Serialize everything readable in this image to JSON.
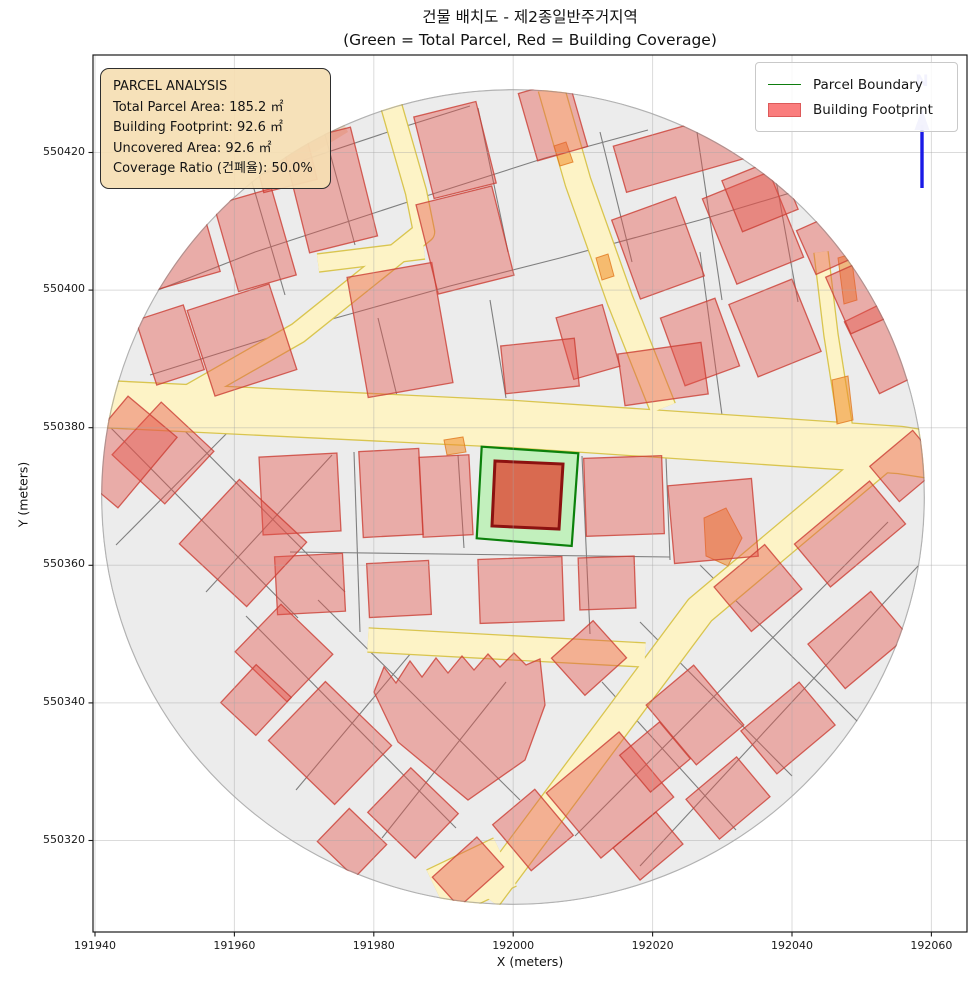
{
  "title": {
    "line1": "건물 배치도 - 제2종일반주거지역",
    "line2": "(Green = Total Parcel, Red = Building Coverage)"
  },
  "axes": {
    "xlabel": "X (meters)",
    "ylabel": "Y (meters)",
    "xticks": [
      191940,
      191960,
      191980,
      192000,
      192020,
      192040,
      192060
    ],
    "yticks": [
      550320,
      550340,
      550360,
      550380,
      550400,
      550420
    ]
  },
  "legend": {
    "items": [
      {
        "label": "Parcel Boundary",
        "swatch": "line",
        "color": "#0e7d0e"
      },
      {
        "label": "Building Footprint",
        "swatch": "patch",
        "color": "#fa7d7d",
        "edge": "#dd5a5a"
      }
    ]
  },
  "info_box": {
    "title": "PARCEL ANALYSIS",
    "lines": [
      "Total Parcel Area: 185.2 ㎡",
      "Building Footprint: 92.6 ㎡",
      "Uncovered Area: 92.6 ㎡",
      "Coverage Ratio (건폐율): 50.0%"
    ]
  },
  "north": {
    "label": "N",
    "line_color": "#1a1ae6",
    "glyph_color": "#b9b9f0"
  },
  "map": {
    "circle": {
      "cx": 513,
      "cy": 497,
      "rx": 412,
      "ry": 408
    },
    "colors": {
      "background": "#ececec",
      "parcel_line": "#7f7f7f",
      "road_fill": "#fdf3c6",
      "road_edge": "#d9c54f",
      "building_fill": "rgba(228,84,74,0.42)",
      "building_edge": "rgba(203,63,53,0.8)",
      "orange_fill": "rgba(240,140,40,0.55)",
      "orange_edge": "rgba(225,120,30,0.8)",
      "tan_fill": "rgba(225,170,110,0.35)",
      "parcel_area_fill": "rgba(190,240,185,0.92)",
      "parcel_area_edge": "#0b800b",
      "footprint_fill": "#d96a50",
      "footprint_edge": "#8c1210",
      "grid": "rgba(165,165,165,0.4)"
    },
    "roads": [
      {
        "pts": [
          [
            102,
            404
          ],
          [
            513,
            424
          ],
          [
            900,
            450
          ],
          [
            932,
            455
          ]
        ],
        "w": 46
      },
      {
        "pts": [
          [
            391,
            105
          ],
          [
            416,
            192
          ],
          [
            424,
            232
          ],
          [
            298,
            333
          ],
          [
            184,
            398
          ]
        ],
        "w": 20
      },
      {
        "pts": [
          [
            318,
            263
          ],
          [
            424,
            250
          ]
        ],
        "w": 17
      },
      {
        "pts": [
          [
            551,
            88
          ],
          [
            578,
            182
          ],
          [
            620,
            300
          ],
          [
            663,
            408
          ]
        ],
        "w": 25
      },
      {
        "pts": [
          [
            821,
            252
          ],
          [
            831,
            335
          ],
          [
            846,
            430
          ]
        ],
        "w": 13
      },
      {
        "pts": [
          [
            888,
            452
          ],
          [
            700,
            610
          ],
          [
            486,
            897
          ]
        ],
        "w": 30
      },
      {
        "pts": [
          [
            368,
            640
          ],
          [
            645,
            655
          ]
        ],
        "w": 23
      },
      {
        "pts": [
          [
            505,
            862
          ],
          [
            438,
            894
          ]
        ],
        "w": 52
      }
    ],
    "parcel_lines": [
      [
        [
          112,
          308
        ],
        [
          255,
          252
        ],
        [
          420,
          198
        ],
        [
          545,
          158
        ],
        [
          648,
          130
        ]
      ],
      [
        [
          135,
          218
        ],
        [
          268,
          172
        ],
        [
          400,
          128
        ],
        [
          470,
          106
        ]
      ],
      [
        [
          150,
          375
        ],
        [
          300,
          328
        ],
        [
          450,
          286
        ],
        [
          560,
          258
        ],
        [
          700,
          220
        ],
        [
          800,
          190
        ],
        [
          880,
          162
        ]
      ],
      [
        [
          228,
          100
        ],
        [
          285,
          295
        ]
      ],
      [
        [
          315,
          98
        ],
        [
          355,
          245
        ]
      ],
      [
        [
          478,
          108
        ],
        [
          508,
          252
        ]
      ],
      [
        [
          600,
          132
        ],
        [
          632,
          262
        ]
      ],
      [
        [
          697,
          132
        ],
        [
          722,
          300
        ]
      ],
      [
        [
          772,
          158
        ],
        [
          798,
          302
        ]
      ],
      [
        [
          378,
          318
        ],
        [
          398,
          400
        ]
      ],
      [
        [
          490,
          300
        ],
        [
          506,
          398
        ]
      ],
      [
        [
          700,
          252
        ],
        [
          722,
          415
        ]
      ],
      [
        [
          354,
          452
        ],
        [
          360,
          632
        ]
      ],
      [
        [
          458,
          455
        ],
        [
          464,
          548
        ]
      ],
      [
        [
          582,
          456
        ],
        [
          590,
          634
        ]
      ],
      [
        [
          666,
          458
        ],
        [
          670,
          560
        ]
      ],
      [
        [
          290,
          552
        ],
        [
          670,
          557
        ]
      ],
      [
        [
          108,
          425
        ],
        [
          298,
          618
        ]
      ],
      [
        [
          152,
          398
        ],
        [
          345,
          592
        ]
      ],
      [
        [
          240,
          420
        ],
        [
          116,
          545
        ]
      ],
      [
        [
          332,
          455
        ],
        [
          206,
          592
        ]
      ],
      [
        [
          246,
          616
        ],
        [
          456,
          828
        ]
      ],
      [
        [
          318,
          600
        ],
        [
          520,
          800
        ]
      ],
      [
        [
          422,
          640
        ],
        [
          296,
          790
        ]
      ],
      [
        [
          506,
          682
        ],
        [
          382,
          838
        ]
      ],
      [
        [
          888,
          522
        ],
        [
          575,
          836
        ]
      ],
      [
        [
          918,
          566
        ],
        [
          640,
          866
        ]
      ],
      [
        [
          700,
          565
        ],
        [
          858,
          722
        ]
      ],
      [
        [
          640,
          622
        ],
        [
          792,
          776
        ]
      ],
      [
        [
          602,
          682
        ],
        [
          736,
          830
        ]
      ]
    ],
    "buildings": [
      [
        175,
        248,
        74,
        70,
        -16
      ],
      [
        255,
        240,
        60,
        90,
        -16
      ],
      [
        282,
        152,
        55,
        70,
        -14
      ],
      [
        330,
        190,
        70,
        112,
        -14
      ],
      [
        170,
        345,
        50,
        68,
        -18
      ],
      [
        242,
        340,
        86,
        90,
        -18
      ],
      [
        400,
        330,
        86,
        122,
        -10
      ],
      [
        455,
        150,
        64,
        84,
        -14
      ],
      [
        465,
        240,
        78,
        92,
        -14
      ],
      [
        553,
        120,
        52,
        70,
        -16
      ],
      [
        680,
        152,
        125,
        48,
        -16
      ],
      [
        658,
        248,
        68,
        84,
        -20
      ],
      [
        753,
        228,
        72,
        92,
        -22
      ],
      [
        775,
        328,
        68,
        78,
        -22
      ],
      [
        700,
        342,
        58,
        72,
        -20
      ],
      [
        588,
        342,
        48,
        64,
        -16
      ],
      [
        888,
        345,
        58,
        80,
        -26
      ],
      [
        862,
        295,
        52,
        62,
        -24
      ],
      [
        760,
        195,
        60,
        55,
        -22
      ],
      [
        830,
        242,
        52,
        48,
        -24
      ],
      [
        540,
        366,
        74,
        48,
        -6
      ],
      [
        663,
        374,
        84,
        52,
        -8
      ],
      [
        300,
        494,
        78,
        78,
        -3
      ],
      [
        391,
        493,
        60,
        86,
        -3
      ],
      [
        446,
        496,
        50,
        80,
        -3
      ],
      [
        624,
        496,
        78,
        78,
        -2
      ],
      [
        713,
        521,
        84,
        78,
        -5
      ],
      [
        310,
        584,
        68,
        58,
        -3
      ],
      [
        399,
        589,
        62,
        54,
        -3
      ],
      [
        521,
        590,
        84,
        64,
        -2
      ],
      [
        607,
        583,
        56,
        52,
        -2
      ],
      [
        163,
        453,
        72,
        72,
        43
      ],
      [
        243,
        543,
        92,
        88,
        43
      ],
      [
        123,
        452,
        64,
        92,
        40
      ],
      [
        284,
        653,
        72,
        66,
        44
      ],
      [
        330,
        743,
        92,
        82,
        44
      ],
      [
        256,
        700,
        48,
        52,
        43
      ],
      [
        413,
        813,
        66,
        62,
        44
      ],
      [
        352,
        843,
        52,
        46,
        44
      ],
      [
        468,
        872,
        60,
        40,
        -42
      ],
      [
        610,
        795,
        95,
        85,
        -40
      ],
      [
        589,
        658,
        56,
        50,
        -42
      ],
      [
        533,
        830,
        55,
        60,
        -40
      ],
      [
        850,
        534,
        98,
        56,
        -40
      ],
      [
        906,
        466,
        56,
        46,
        -40
      ],
      [
        758,
        588,
        66,
        58,
        -40
      ],
      [
        858,
        640,
        82,
        58,
        -40
      ],
      [
        695,
        715,
        62,
        78,
        -40
      ],
      [
        788,
        728,
        76,
        56,
        -40
      ],
      [
        655,
        757,
        52,
        48,
        -40
      ],
      [
        728,
        798,
        66,
        52,
        -40
      ],
      [
        648,
        846,
        56,
        42,
        -40
      ]
    ],
    "saw_building": [
      [
        374,
        692
      ],
      [
        384,
        667
      ],
      [
        396,
        683
      ],
      [
        410,
        661
      ],
      [
        422,
        677
      ],
      [
        436,
        658
      ],
      [
        448,
        673
      ],
      [
        462,
        656
      ],
      [
        474,
        670
      ],
      [
        488,
        654
      ],
      [
        500,
        667
      ],
      [
        514,
        653
      ],
      [
        526,
        665
      ],
      [
        540,
        659
      ],
      [
        545,
        705
      ],
      [
        525,
        760
      ],
      [
        468,
        800
      ],
      [
        398,
        742
      ]
    ],
    "tan_patch": [
      [
        268,
        162
      ],
      [
        300,
        130
      ],
      [
        338,
        112
      ],
      [
        348,
        132
      ],
      [
        302,
        160
      ]
    ],
    "orange_buildings": [
      [
        [
          838,
          258
        ],
        [
          851,
          254
        ],
        [
          857,
          300
        ],
        [
          844,
          304
        ]
      ],
      [
        [
          832,
          380
        ],
        [
          848,
          376
        ],
        [
          853,
          420
        ],
        [
          837,
          424
        ]
      ],
      [
        [
          704,
          518
        ],
        [
          726,
          508
        ],
        [
          742,
          538
        ],
        [
          728,
          566
        ],
        [
          706,
          556
        ]
      ],
      [
        [
          444,
          440
        ],
        [
          463,
          437
        ],
        [
          466,
          452
        ],
        [
          447,
          455
        ]
      ],
      [
        [
          554,
          146
        ],
        [
          566,
          142
        ],
        [
          573,
          162
        ],
        [
          560,
          166
        ]
      ],
      [
        [
          596,
          258
        ],
        [
          608,
          254
        ],
        [
          614,
          276
        ],
        [
          602,
          280
        ]
      ]
    ],
    "parcel_polygon": [
      [
        481.7,
        446.7
      ],
      [
        578.3,
        453.3
      ],
      [
        571.7,
        546
      ],
      [
        476.7,
        538.3
      ]
    ],
    "footprint_polygon": [
      [
        495,
        461
      ],
      [
        563,
        464
      ],
      [
        559,
        529
      ],
      [
        492,
        526
      ]
    ]
  }
}
